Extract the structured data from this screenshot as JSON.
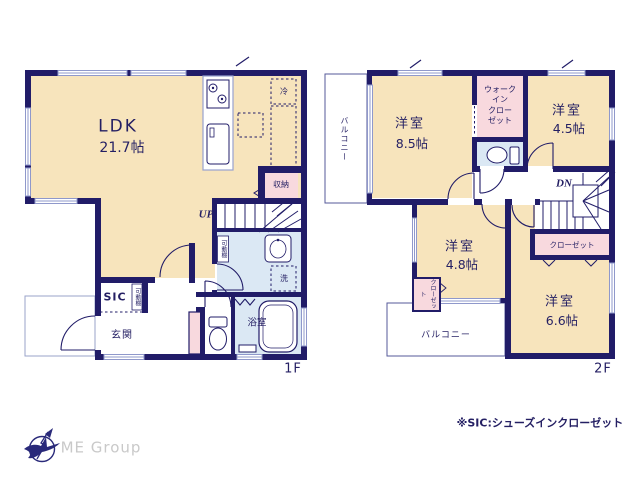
{
  "colors": {
    "wall_navy": "#211c68",
    "room_cream": "#f7e4bc",
    "wet_blue": "#dbe8f4",
    "closet_pink": "#f8d9de",
    "text_navy": "#241f63",
    "window_light": "#8f98cb",
    "logo_gray": "#c9c9c9"
  },
  "f1": {
    "label": "1F",
    "ldk_name": "LDK",
    "ldk_size": "21.7帖",
    "storage": "収納",
    "fridge": "冷",
    "stairs": "UP",
    "shelf_wash": "可動棚",
    "shelf_sic": "可動棚",
    "sic": "SIC",
    "genkan": "玄関",
    "washer": "洗",
    "bath": "浴室"
  },
  "f2": {
    "label": "2F",
    "balcony_west": "バルコニー",
    "balcony_south": "バルコニー",
    "room_nw_name": "洋室",
    "room_nw_size": "8.5帖",
    "wic_lines": [
      "ウォーク",
      "イン",
      "クロー",
      "ゼット"
    ],
    "room_ne_name": "洋室",
    "room_ne_size": "4.5帖",
    "stairs": "DN",
    "closet_east": "クローゼット",
    "room_sw_name": "洋室",
    "room_sw_size": "4.8帖",
    "closet_sw": "クローゼット",
    "room_se_name": "洋室",
    "room_se_size": "6.6帖"
  },
  "footer": {
    "note": "※SIC:シューズインクローゼット",
    "logo_text": "ME Group"
  }
}
